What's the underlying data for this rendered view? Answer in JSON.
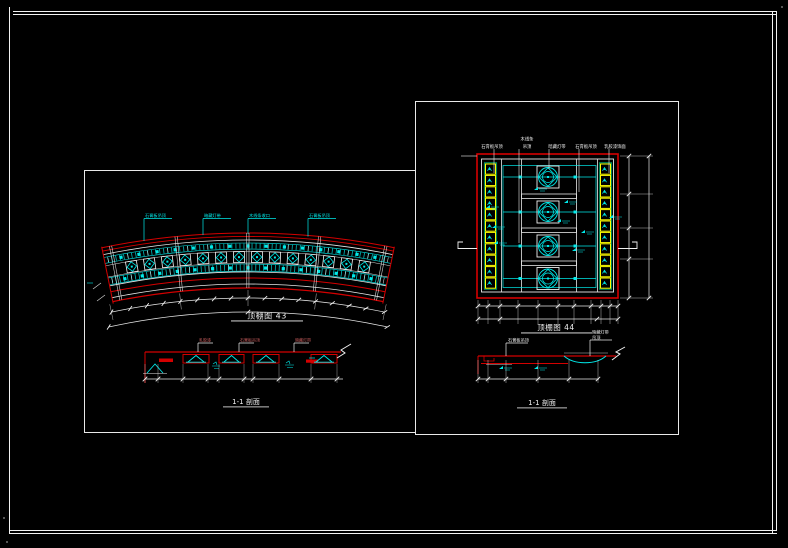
{
  "window": {
    "background": "#000000",
    "frame_color": "#f2f2f2"
  },
  "colors": {
    "line_red": "#d40000",
    "accent_cyan": "#00eaea",
    "accent_yellow": "#ffff00",
    "rim_green": "#00cc88",
    "line_white": "#e8e8e8",
    "callout_red": "#c75c5c"
  },
  "left_panel": {
    "plan_title": "顶棚图 43",
    "plan_callouts": [
      "石膏板吊顶",
      "暗藏灯带",
      "木线条收口",
      "石膏板吊顶"
    ],
    "coffer_count": 14,
    "section_title": "1-1 剖面",
    "section_callouts": [
      "乳胶漆",
      "石膏板吊顶",
      "暗藏灯带"
    ]
  },
  "right_panel": {
    "plan_title": "顶棚图 44",
    "plan_callouts": [
      "石膏板吊顶",
      "木线条",
      "吊顶",
      "暗藏灯带",
      "石膏板吊顶",
      "乳胶漆饰面"
    ],
    "medallion_count": 4,
    "side_panel_count": 11,
    "section_title": "1-1 剖面",
    "section_callouts": [
      "石膏板吊顶",
      "暗藏灯带",
      "吊顶"
    ]
  }
}
